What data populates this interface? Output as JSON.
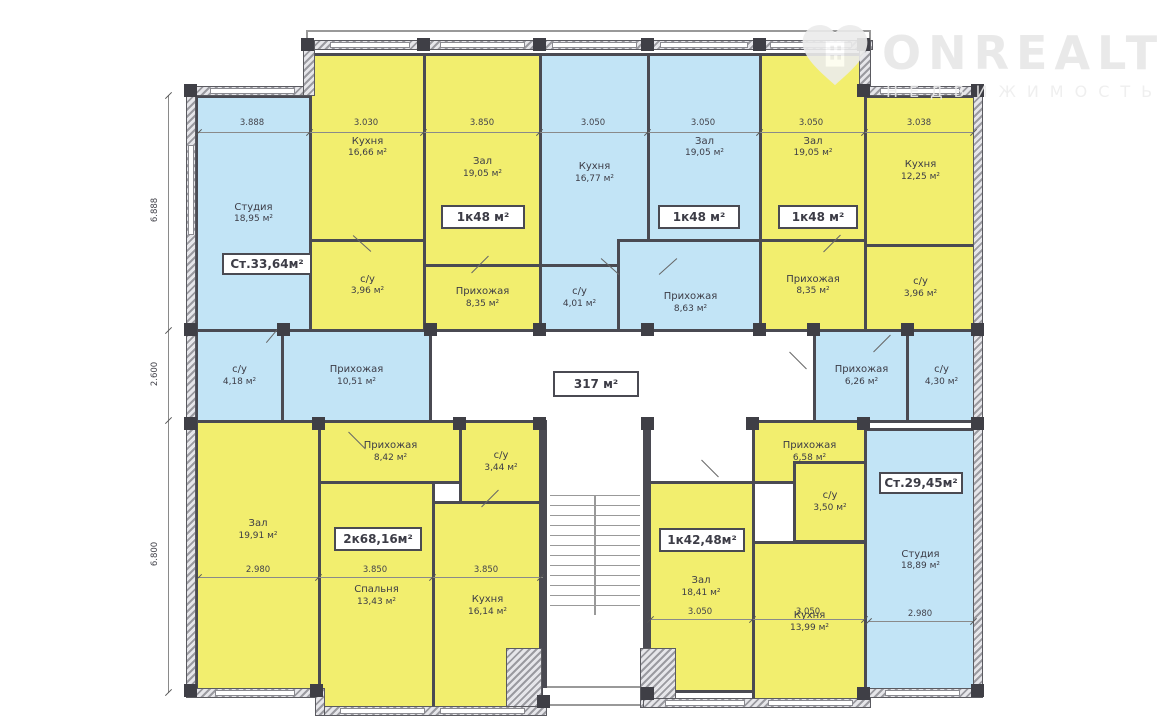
{
  "watermark": {
    "brand": "ONREALT",
    "subtitle": "НЕДВИЖИМОСТЬ"
  },
  "corridor": {
    "label": "317 м²"
  },
  "apartment_labels": [
    "Ст.33,64м²",
    "1к48 м²",
    "1к48 м²",
    "1к48 м²",
    "2к68,16м²",
    "1к42,48м²",
    "Ст.29,45м²"
  ],
  "rooms": [
    {
      "name": "Студия",
      "area": "18,95 м²"
    },
    {
      "name": "Кухня",
      "area": "16,66 м²"
    },
    {
      "name": "Зал",
      "area": "19,05 м²"
    },
    {
      "name": "с/у",
      "area": "3,96 м²"
    },
    {
      "name": "Прихожая",
      "area": "8,35 м²"
    },
    {
      "name": "Кухня",
      "area": "16,77 м²"
    },
    {
      "name": "Зал",
      "area": "19,05 м²"
    },
    {
      "name": "с/у",
      "area": "4,01 м²"
    },
    {
      "name": "Прихожая",
      "area": "8,63 м²"
    },
    {
      "name": "Зал",
      "area": "19,05 м²"
    },
    {
      "name": "Прихожая",
      "area": "8,35 м²"
    },
    {
      "name": "Кухня",
      "area": "12,25 м²"
    },
    {
      "name": "с/у",
      "area": "3,96 м²"
    },
    {
      "name": "с/у",
      "area": "4,18 м²"
    },
    {
      "name": "Прихожая",
      "area": "10,51 м²"
    },
    {
      "name": "Прихожая",
      "area": "6,26 м²"
    },
    {
      "name": "с/у",
      "area": "4,30 м²"
    },
    {
      "name": "Зал",
      "area": "19,91 м²"
    },
    {
      "name": "Прихожая",
      "area": "8,42 м²"
    },
    {
      "name": "с/у",
      "area": "3,44 м²"
    },
    {
      "name": "Спальня",
      "area": "13,43 м²"
    },
    {
      "name": "Кухня",
      "area": "16,14 м²"
    },
    {
      "name": "Прихожая",
      "area": "6,58 м²"
    },
    {
      "name": "с/у",
      "area": "3,50 м²"
    },
    {
      "name": "Зал",
      "area": "18,41 м²"
    },
    {
      "name": "Кухня",
      "area": "13,99 м²"
    },
    {
      "name": "Студия",
      "area": "18,89 м²"
    }
  ],
  "dimensions": {
    "top": [
      "3.888",
      "3.030",
      "3.850",
      "3.050",
      "3.050",
      "3.050",
      "3.038"
    ],
    "left": [
      "6.888",
      "2.600",
      "6.800"
    ],
    "bottom_left_apartment": [
      "2.980",
      "3.850",
      "3.850"
    ],
    "bottom_middle_apartment": [
      "3.050",
      "3.050"
    ],
    "bottom_right_studio": [
      "2.980"
    ]
  },
  "colors": {
    "room_yellow": "#f2ee6e",
    "room_blue": "#c2e4f6",
    "wall": "#4a4a52"
  }
}
